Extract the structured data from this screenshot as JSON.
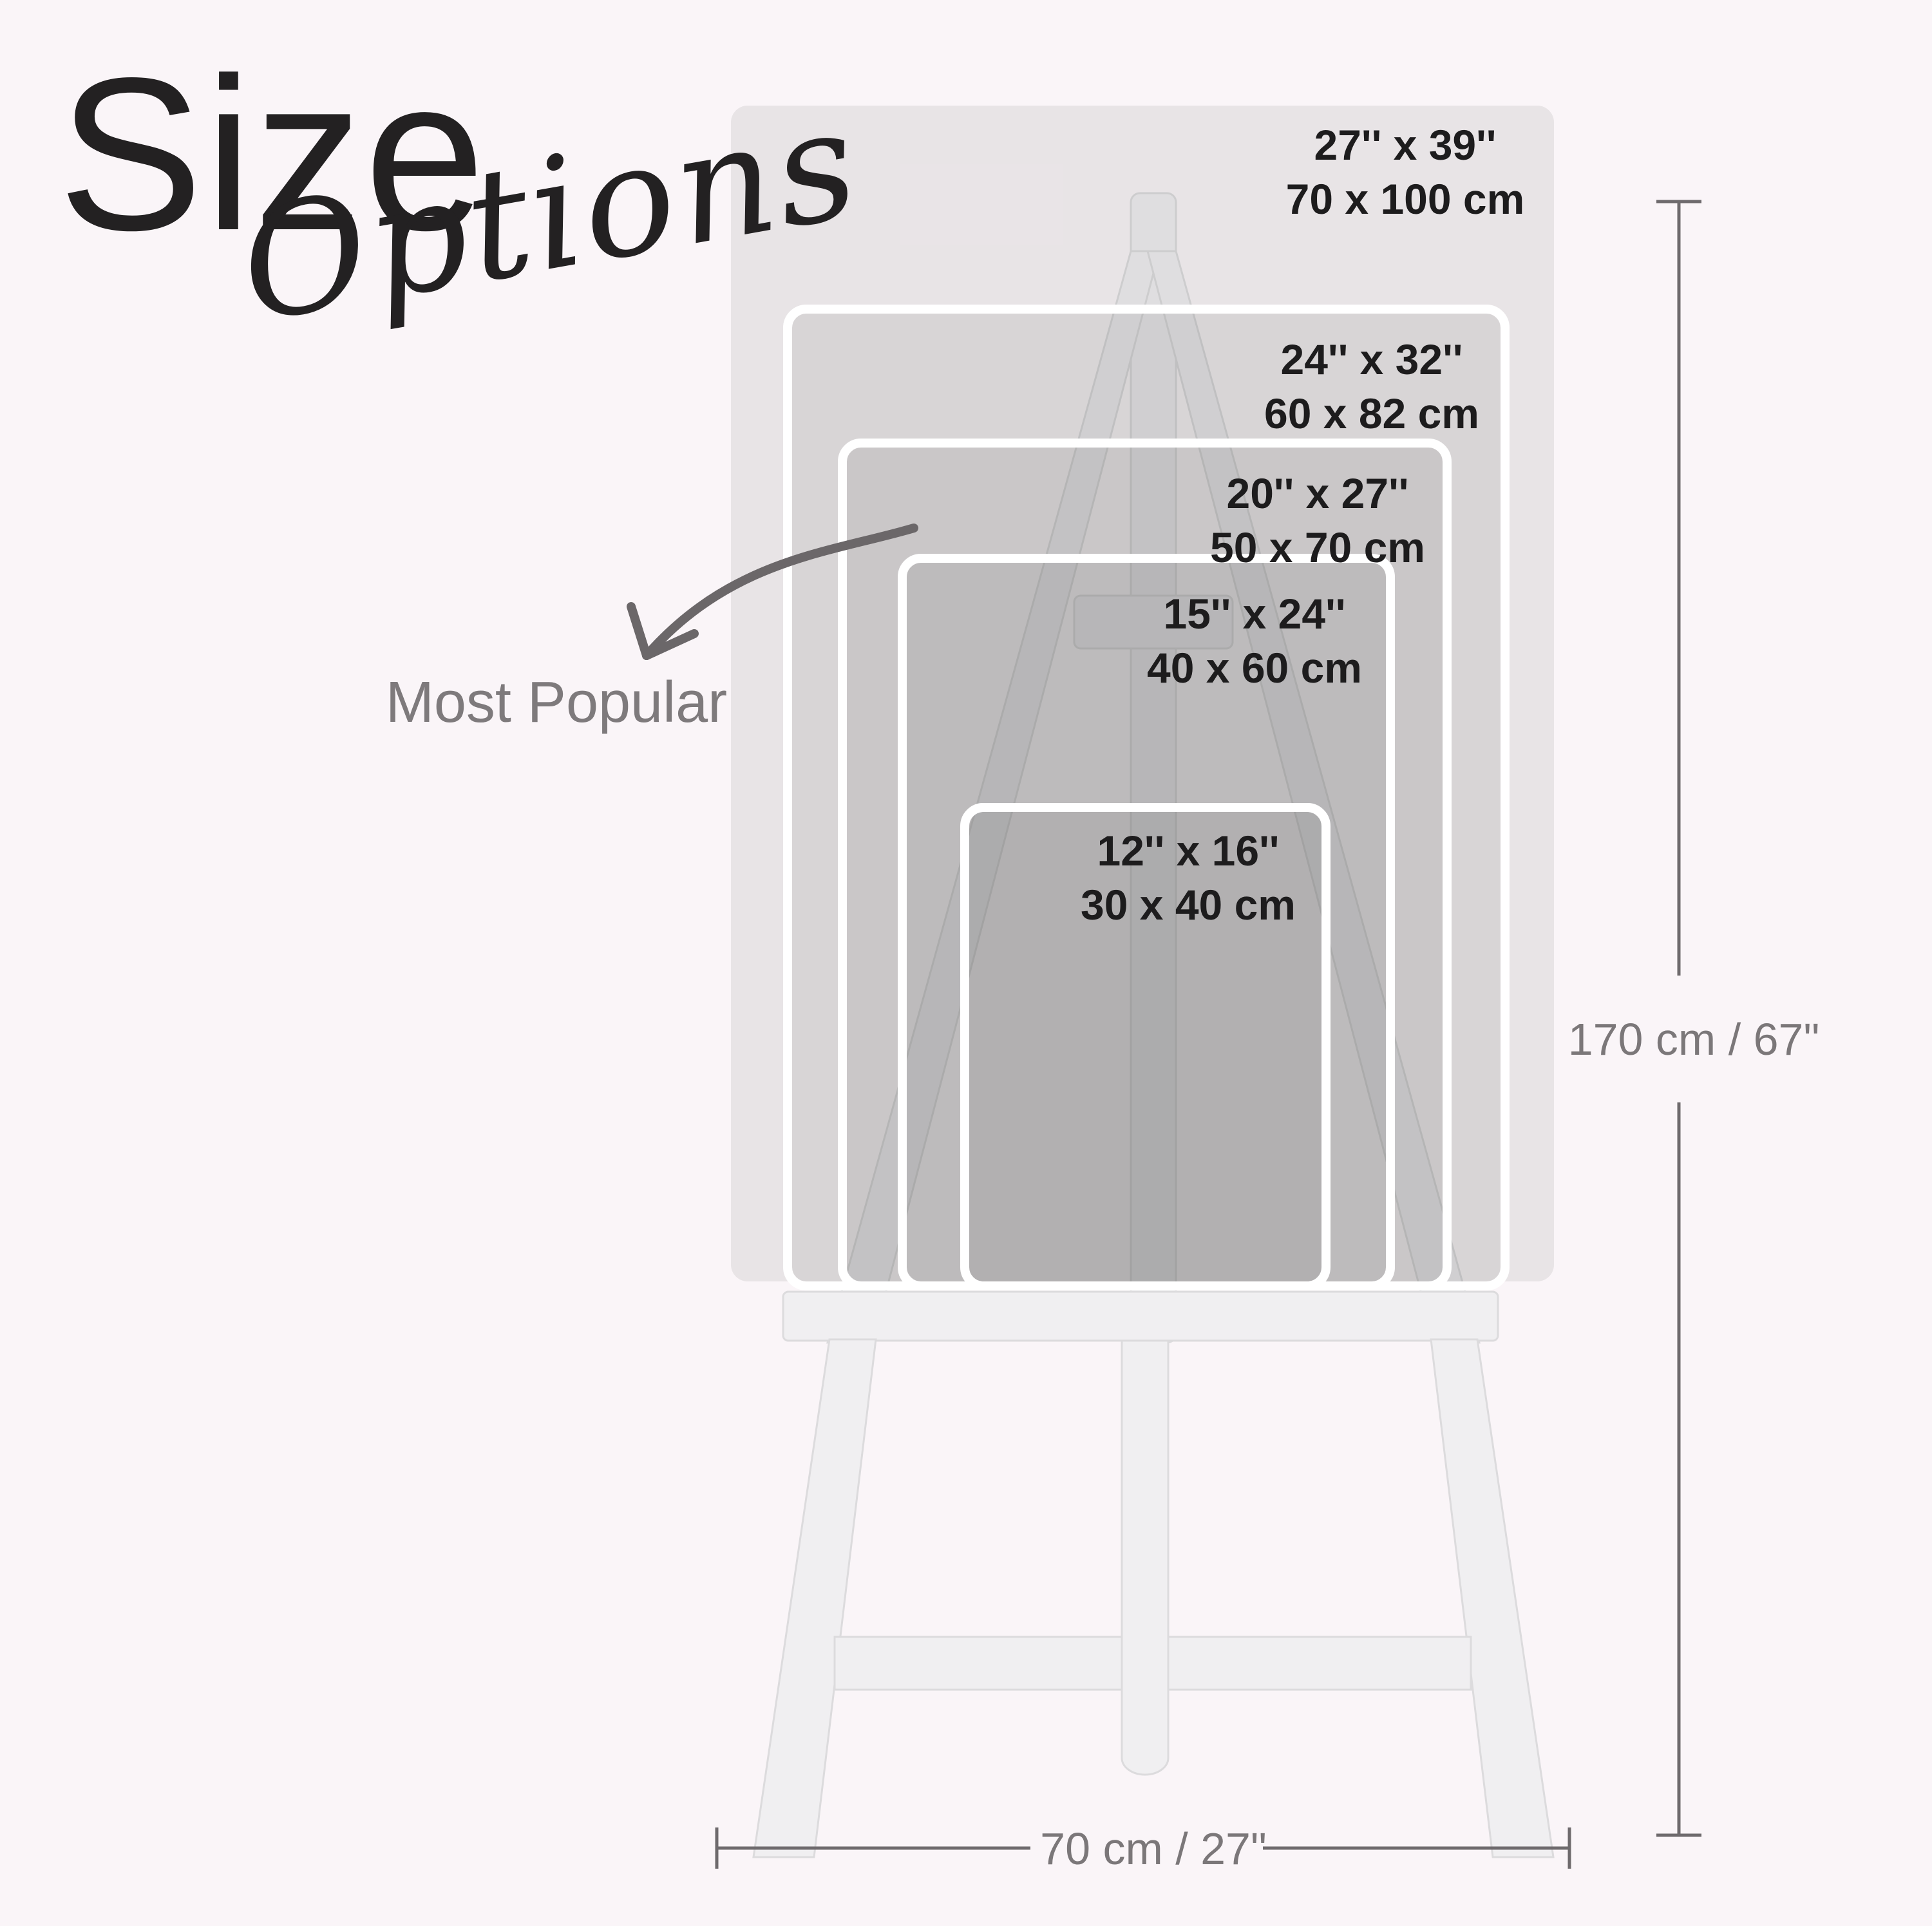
{
  "page": {
    "background_color": "#faf5f8",
    "easel_color": "#f0eff1",
    "layer_tint": "rgba(92,88,92,0.11)",
    "accent_text_color": "#1d1c1d",
    "muted_text_color": "#7b7779",
    "arrow_color": "#6b6769"
  },
  "title": {
    "word_main": "Size",
    "word_script": "Options"
  },
  "annotation": {
    "most_popular_label": "Most Popular",
    "arrow_icon": "curved-arrow-down-left"
  },
  "sizes": [
    {
      "inches": "27'' x 39''",
      "cm": "70 x 100 cm"
    },
    {
      "inches": "24'' x 32''",
      "cm": "60 x 82 cm"
    },
    {
      "inches": "20'' x 27''",
      "cm": "50 x 70 cm"
    },
    {
      "inches": "15'' x 24''",
      "cm": "40 x 60 cm"
    },
    {
      "inches": "12'' x 16''",
      "cm": "30 x 40 cm"
    }
  ],
  "dimensions": {
    "height_label": "170 cm / 67\"",
    "width_label": "70 cm / 27\""
  }
}
